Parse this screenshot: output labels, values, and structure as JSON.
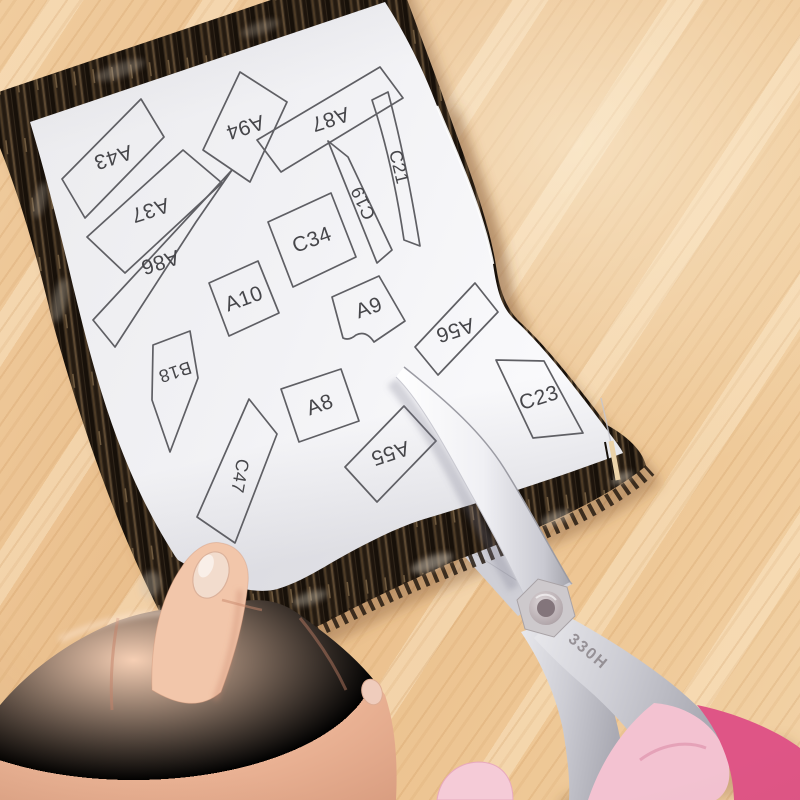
{
  "photo": {
    "pieces": [
      {
        "label": "A43"
      },
      {
        "label": "A37"
      },
      {
        "label": "A86"
      },
      {
        "label": "A94"
      },
      {
        "label": "A87"
      },
      {
        "label": "C21"
      },
      {
        "label": "C19"
      },
      {
        "label": "C34"
      },
      {
        "label": "A10"
      },
      {
        "label": "A9"
      },
      {
        "label": "B18"
      },
      {
        "label": "A8"
      },
      {
        "label": "C47"
      },
      {
        "label": "A55"
      },
      {
        "label": "A56"
      },
      {
        "label": "C23"
      }
    ],
    "scissors": {
      "blade_stamp": "330H"
    },
    "colors": {
      "wood": "#edc694",
      "fabric_dark": "#31261a",
      "paper": "#f1f1f4",
      "pattern_outline": "#5f5f64",
      "label_text": "#46464a",
      "blade_silver": "#eeeef2",
      "handle_pink_dark": "#df5586",
      "handle_pink_light": "#f3c2d1",
      "skin": "#eebb9e"
    }
  }
}
